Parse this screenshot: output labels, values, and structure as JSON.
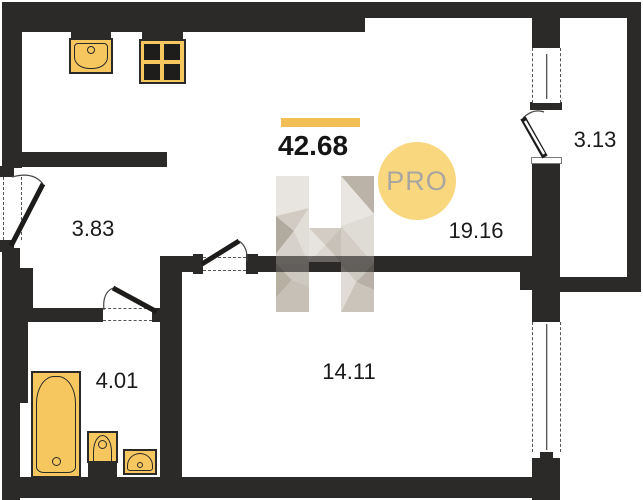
{
  "plan": {
    "type": "apartment-floor-plan",
    "total_area": "42.68",
    "badge": "PRO",
    "logo_letter": "H",
    "rooms": [
      {
        "name": "hallway",
        "area": "3.83"
      },
      {
        "name": "bathroom",
        "area": "4.01"
      },
      {
        "name": "bedroom",
        "area": "14.11"
      },
      {
        "name": "kitchen-living",
        "area": "19.16"
      },
      {
        "name": "balcony",
        "area": "3.13"
      }
    ],
    "fixtures": [
      "kitchen-sink",
      "stove",
      "bathtub",
      "toilet",
      "washbasin"
    ],
    "openings": [
      "entrance-door",
      "bathroom-door",
      "bedroom-door",
      "balcony-door",
      "balcony-window",
      "bedroom-window"
    ],
    "colors": {
      "wall": "#2b2a29",
      "accent_bar": "#f2bf55",
      "fixture_fill": "#f6c75f",
      "badge_bg": "#f8d77e",
      "badge_text": "#a9a5a1",
      "logo_facets": [
        "#e7e3dd",
        "#cec8bf",
        "#aca497",
        "#dcd8d1",
        "#b6aea2"
      ]
    }
  }
}
